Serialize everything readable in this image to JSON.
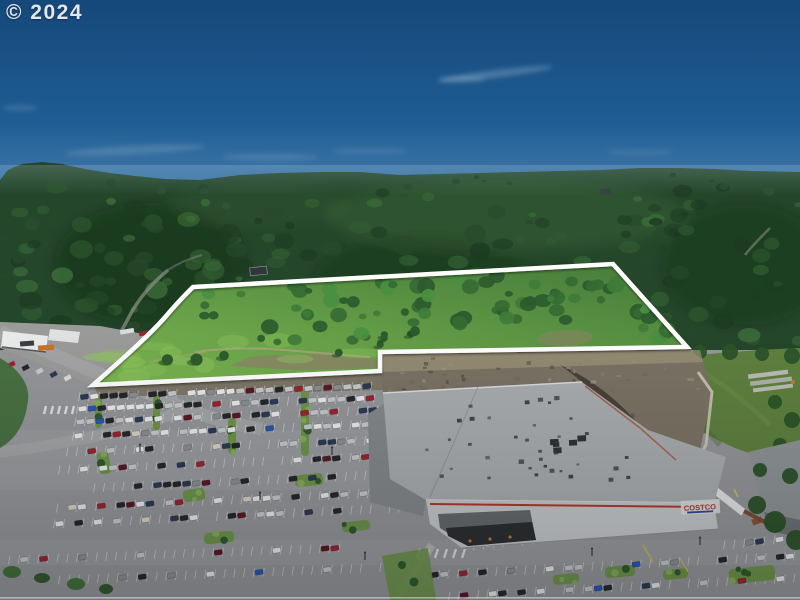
{
  "watermark": {
    "text": "© 2024"
  },
  "building": {
    "sign_label": "COSTCO"
  },
  "palette": {
    "sky_top": "#16487A",
    "sky_mid": "#1E5C93",
    "sky_horizon": "#4A80AE",
    "forest_green": "#24462A",
    "meadow_light": "#7CB750",
    "meadow_shade": "#447A3A",
    "boundary_white": "#FFFFFF",
    "roof_gray": "#A9ADAF",
    "wall_gray": "#C6C9CA",
    "costco_red": "#B5352B",
    "costco_blue": "#2A4B9B",
    "asphalt_gray": "#949699",
    "dirt_brown": "#7A7263",
    "grass_slope_green": "#5F803F"
  }
}
